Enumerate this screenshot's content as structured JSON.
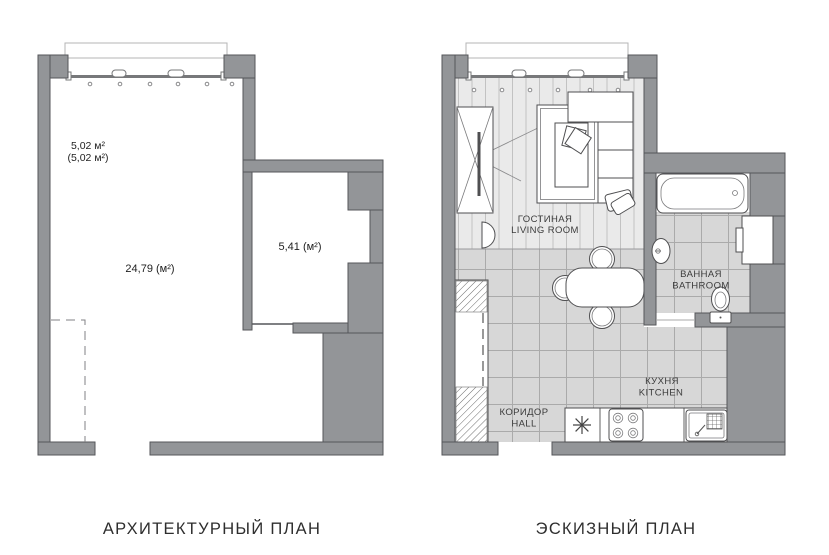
{
  "captions": {
    "left": "АРХИТЕКТУРНЫЙ ПЛАН",
    "right": "ЭСКИЗНЫЙ ПЛАН"
  },
  "left_plan": {
    "balcony_area_line1": "5,02 м²",
    "balcony_area_line2": "(5,02 м²)",
    "main_room_area": "24,79 (м²)",
    "small_room_area": "5,41 (м²)"
  },
  "right_plan": {
    "rooms": {
      "living_room": {
        "ru": "ГОСТИНАЯ",
        "en": "LIVING ROOM"
      },
      "bathroom": {
        "ru": "ВАННАЯ",
        "en": "BATHROOM"
      },
      "kitchen": {
        "ru": "КУХНЯ",
        "en": "KITCHEN"
      },
      "hall": {
        "ru": "КОРИДОР",
        "en": "HALL"
      }
    },
    "furniture_icons": [
      "wardrobe-icon",
      "tv-icon",
      "rug",
      "coffee-table",
      "blanket-icon",
      "corner-sofa",
      "pillow-icon",
      "pouf-icon",
      "hall-closet-icon",
      "dining-table",
      "chair-icon",
      "bathtub-icon",
      "washbasin-icon",
      "toilet-icon",
      "washing-machine-icon",
      "kitchen-counter",
      "kitchen-sink-symbol",
      "stove-icon",
      "sink-unit-icon",
      "radiator-dots",
      "window",
      "balcony-outline"
    ]
  },
  "colors": {
    "wall_fill": "#939598",
    "wall_outline": "#55565a",
    "wood_floor": "#eaeaea",
    "wood_stripe": "#c2c2c2",
    "tile_floor": "#d7d7d7",
    "tile_line": "#aaaaaa",
    "furniture_outline": "#4f4f51",
    "label_text": "#3c3c3c",
    "caption_text": "#2e2e2e"
  }
}
